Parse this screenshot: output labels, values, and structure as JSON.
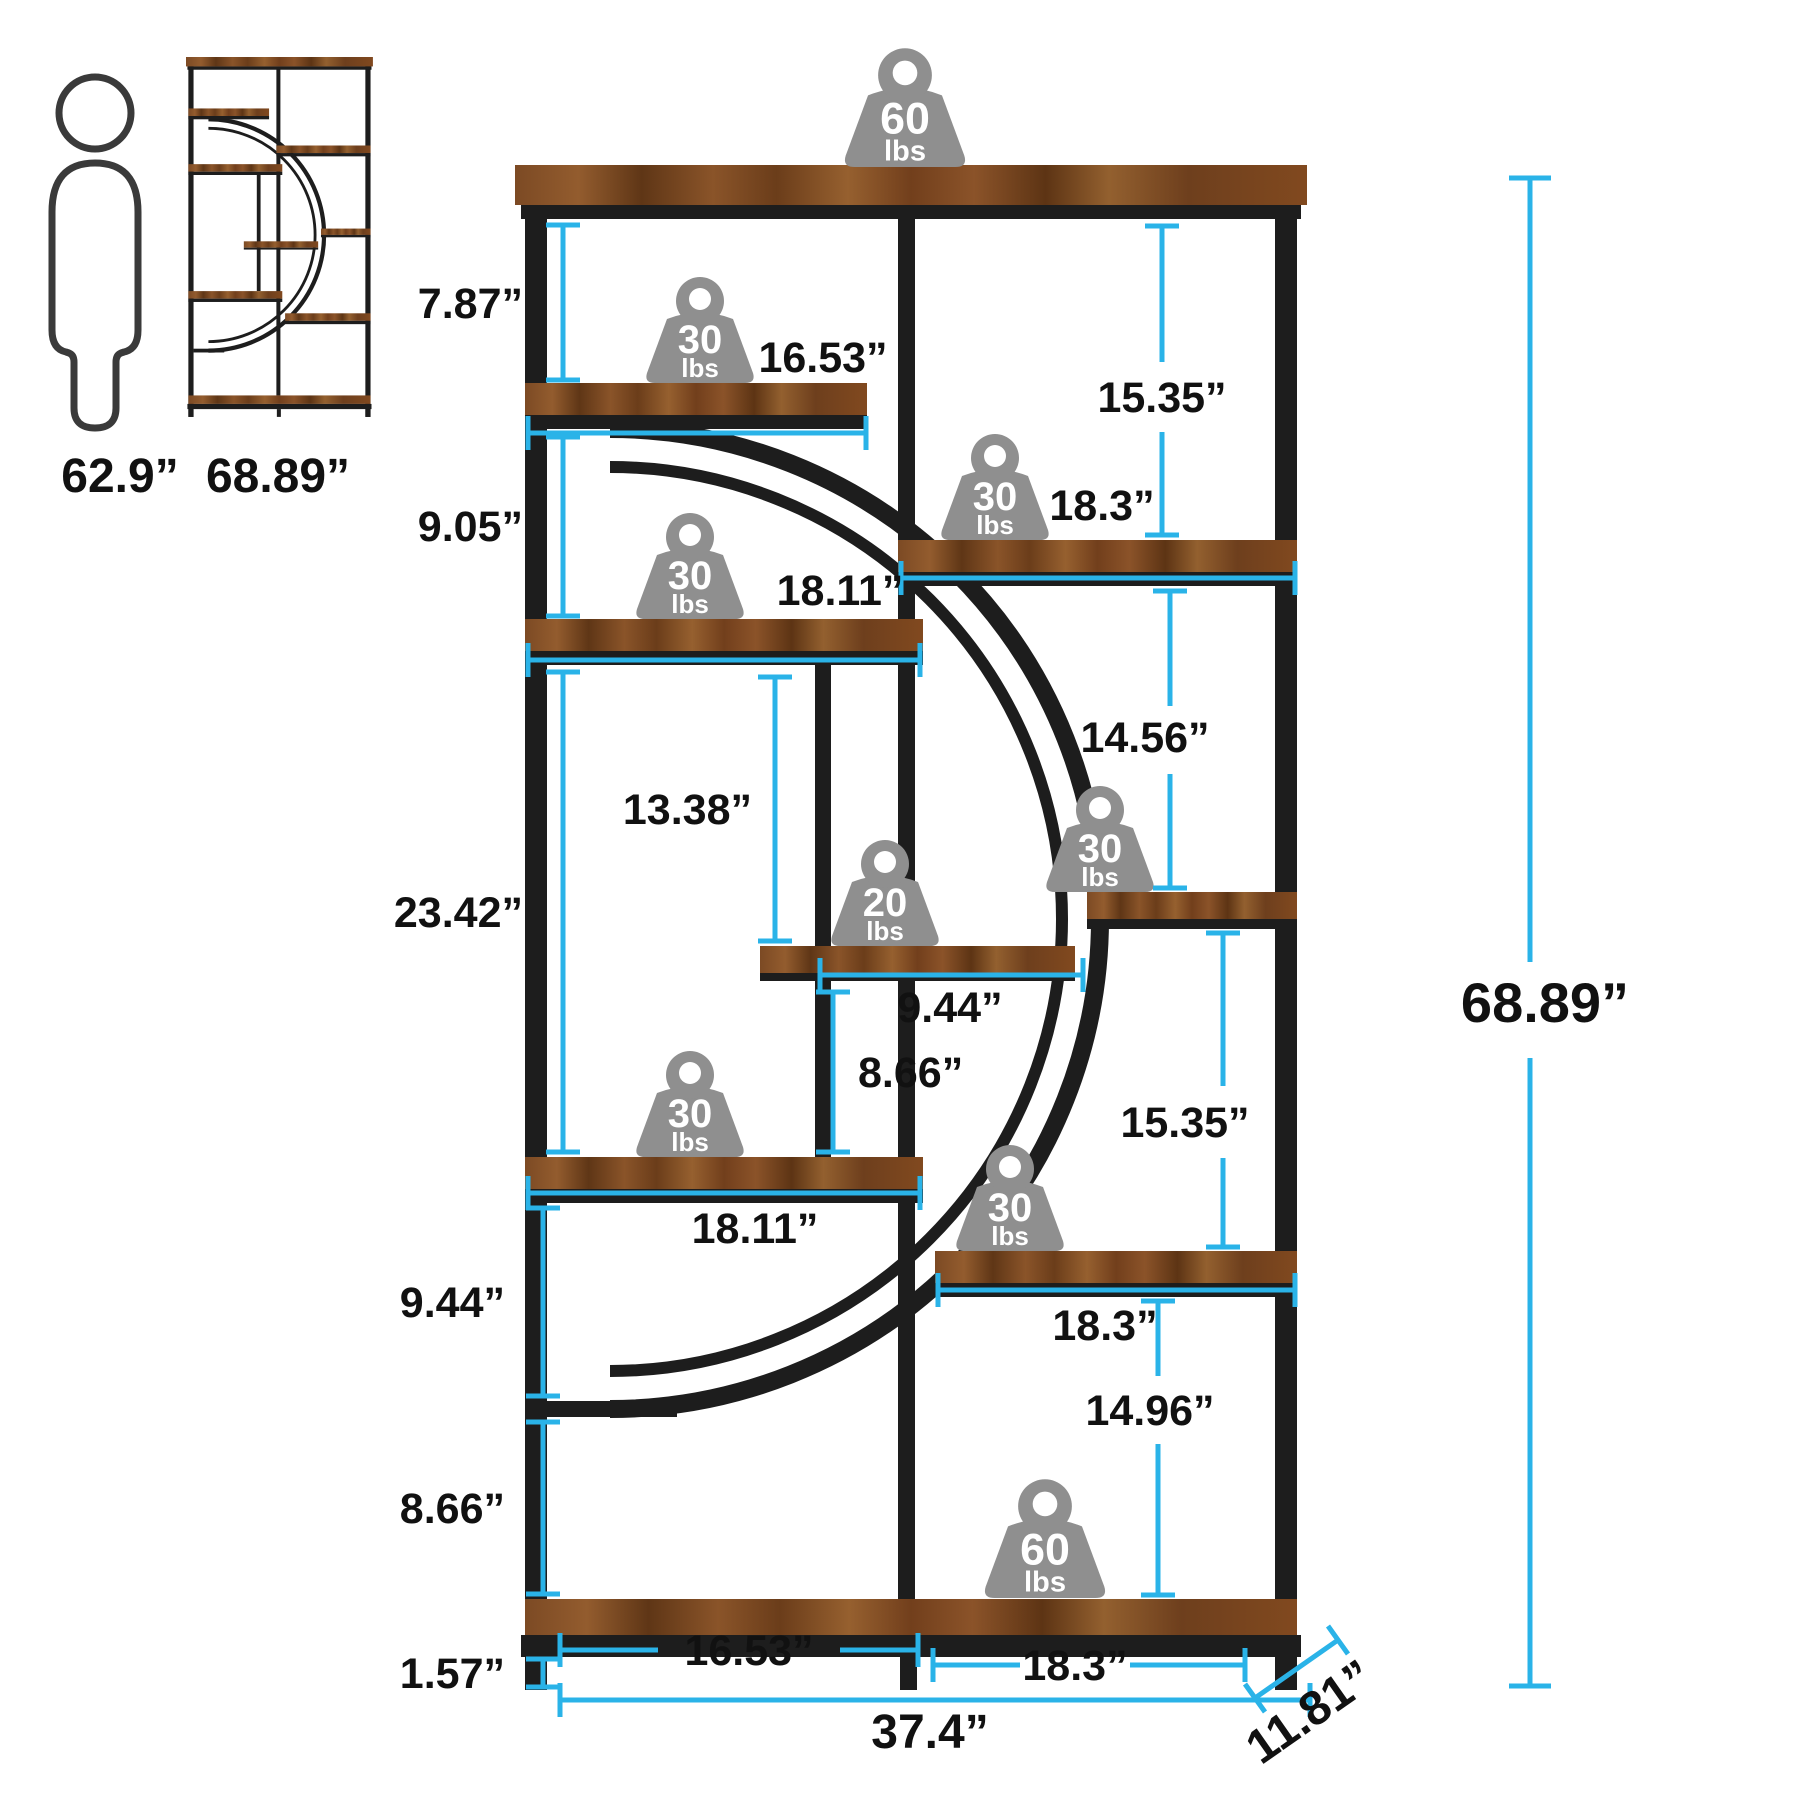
{
  "diagram_type": "furniture-dimension-diagram",
  "colors": {
    "accent_cyan": "#2ab3e8",
    "frame_black": "#1d1d1d",
    "wood_brown": "#7c4a24",
    "weight_gray": "#8f8f8f",
    "text_black": "#111111"
  },
  "scale_reference": {
    "human_height": "62.9”",
    "product_height": "68.89”"
  },
  "left_dimensions": [
    "7.87”",
    "9.05”",
    "23.42”",
    "9.44”",
    "8.66”",
    "1.57”"
  ],
  "right_dimensions": {
    "top_gap": "15.35”",
    "upper_gap": "14.56”",
    "lower_gap": "15.35”",
    "bottom_gap": "14.96”",
    "overall_height": "68.89”"
  },
  "shelf_dimensions": {
    "shelf1_width": "16.53”",
    "shelf2_width": "18.3”",
    "shelf3_width": "18.11”",
    "mid_opening_height": "13.38”",
    "mid_shelf_width": "9.44”",
    "mid_lower_gap": "8.66”",
    "shelf6_width": "18.11”",
    "shelf7_width": "18.3”",
    "bottom_left_width": "16.53”",
    "bottom_right_width": "18.3”"
  },
  "base_dimensions": {
    "overall_width": "37.4”",
    "depth": "11.81”"
  },
  "weight_capacities": [
    {
      "location": "top-shelf",
      "value": "60",
      "unit": "lbs"
    },
    {
      "location": "shelf-1",
      "value": "30",
      "unit": "lbs"
    },
    {
      "location": "shelf-2",
      "value": "30",
      "unit": "lbs"
    },
    {
      "location": "shelf-3",
      "value": "30",
      "unit": "lbs"
    },
    {
      "location": "middle-shelf",
      "value": "20",
      "unit": "lbs"
    },
    {
      "location": "arc-shelf",
      "value": "30",
      "unit": "lbs"
    },
    {
      "location": "shelf-6",
      "value": "30",
      "unit": "lbs"
    },
    {
      "location": "shelf-7",
      "value": "30",
      "unit": "lbs"
    },
    {
      "location": "bottom-shelf",
      "value": "60",
      "unit": "lbs"
    }
  ]
}
